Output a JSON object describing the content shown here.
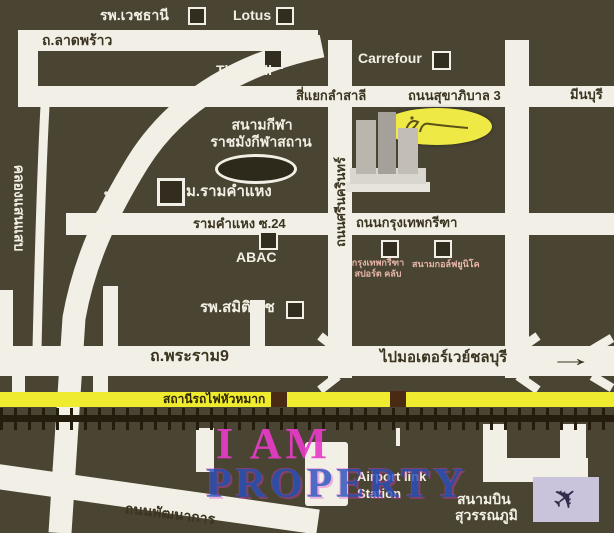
{
  "colors": {
    "background": "#4a4533",
    "road": "#f2f0e6",
    "road_text": "#3a3420",
    "white_text": "#f2efe4",
    "yellow_road": "#efec2f",
    "railway": "#241c0c",
    "station_square": "#4a2a12",
    "watermark_pink": "#e83cc8",
    "watermark_blue": "#2a50bc",
    "plane_box": "#c9c3dc",
    "logo_yellow": "#eee945",
    "poi_text_pink": "#e6b4a8"
  },
  "map": {
    "top": {
      "vejthani": "รพ.เวชธานี",
      "lotus": "Lotus",
      "ladprao": "ถ.ลาดพร้าว",
      "the_mall": "The Mall",
      "carrefour": "Carrefour",
      "lamsali": "สี่แยกลำสาลี",
      "sukhaphiban3": "ถนนสุขาภิบาล 3",
      "minburi": "มีนบุรี"
    },
    "middle": {
      "stadium_line1": "สนามกีฬา",
      "stadium_line2": "ราชมังกีฬาสถาน",
      "ram_university": "ม.รามคำแหง",
      "ramkhamhaeng_road": "ถ.รามคำแหง",
      "saensaep_canal": "คลองแสนแสบ",
      "soi24": "รามคำแหง ซ.24",
      "abac": "ABAC",
      "samitivej": "รพ.สมิติเวช",
      "srinagarindra": "ถนนศรีนครินทร์",
      "krungthep_kreetha": "ถนนกรุงเทพกรีฑา",
      "sportclub_line1": "กรุงเทพกรีฑา",
      "sportclub_line2": "สปอร์ต คลับ",
      "golf": "สนามกอล์ฟยูนิโค"
    },
    "bottom": {
      "rama9": "ถ.พระราม9",
      "motorway": "ไปมอเตอร์เวย์ชลบุรี",
      "huamak_station": "สถานีรถไฟหัวหมาก",
      "phatthanakan": "ถนนพัฒนาการ",
      "airportlink_line1": "Airport link",
      "airportlink_line2": "Station",
      "airport_line1": "สนามบิน",
      "airport_line2": "สุวรรณภูมิ"
    }
  },
  "watermark": {
    "line1": "I AM",
    "line2": "PROPERTY"
  },
  "icons": {
    "arrow_right": "→",
    "plane": "✈"
  }
}
